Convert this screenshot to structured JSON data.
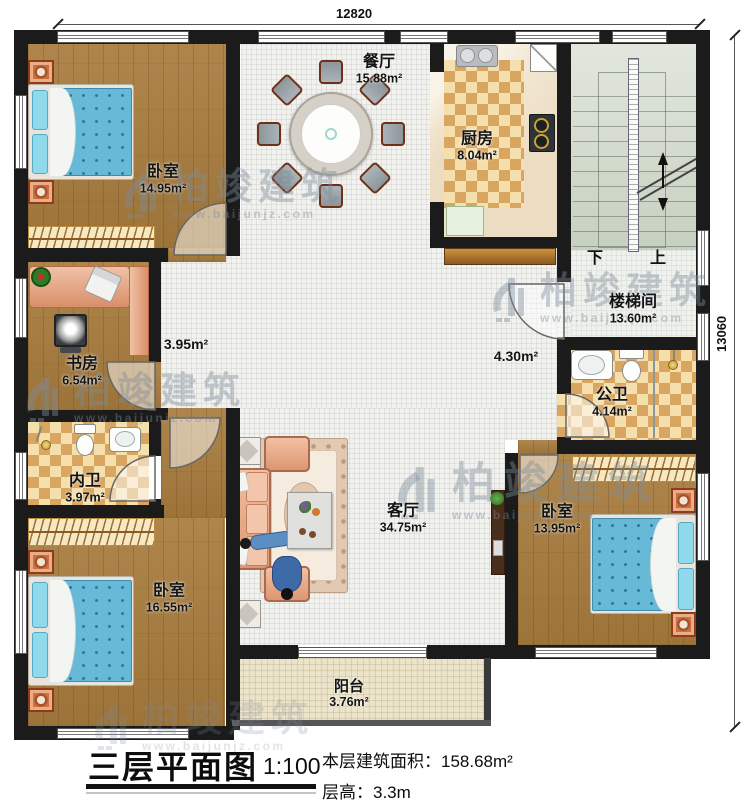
{
  "plan": {
    "dim_top": "12820",
    "dim_right": "13060",
    "stairs": {
      "down": "下",
      "up": "上"
    },
    "rooms": {
      "bedroom_tl": {
        "name": "卧室",
        "area": "14.95m²"
      },
      "dining": {
        "name": "餐厅",
        "area": "15.88m²"
      },
      "kitchen": {
        "name": "厨房",
        "area": "8.04m²"
      },
      "stairwell": {
        "name": "楼梯间",
        "area": "13.60m²"
      },
      "hall_left": {
        "area": "3.95m²"
      },
      "hall_right": {
        "area": "4.30m²"
      },
      "study": {
        "name": "书房",
        "area": "6.54m²"
      },
      "bath_public": {
        "name": "公卫",
        "area": "4.14m²"
      },
      "bath_private": {
        "name": "内卫",
        "area": "3.97m²"
      },
      "living": {
        "name": "客厅",
        "area": "34.75m²"
      },
      "bedroom_bl": {
        "name": "卧室",
        "area": "16.55m²"
      },
      "bedroom_br": {
        "name": "卧室",
        "area": "13.95m²"
      },
      "balcony": {
        "name": "阳台",
        "area": "3.76m²"
      }
    }
  },
  "watermark": {
    "brand": "柏竣建筑",
    "url": "www.baijunjz.com"
  },
  "titleblock": {
    "title": "三层平面图",
    "scale": "1:100",
    "area_label": "本层建筑面积：",
    "area_value": "158.68m²",
    "height_label": "层高：",
    "height_value": "3.3m"
  },
  "colors": {
    "wall": "#1b1b1b",
    "wood": "#a87c3e",
    "bed_blue": "#67b9d8",
    "checker": "#d9a661",
    "salmon": "#eaa988"
  }
}
